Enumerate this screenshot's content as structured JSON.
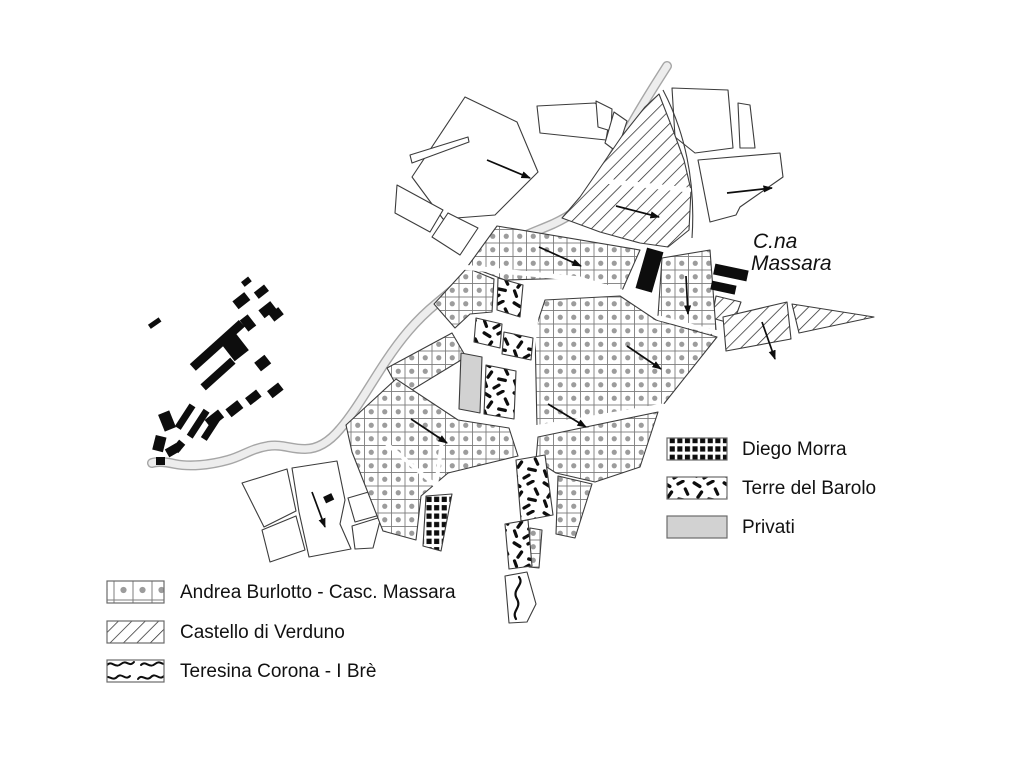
{
  "map_label": {
    "line1": "C.na",
    "line2": "Massara"
  },
  "legend_right": {
    "items": [
      {
        "label": "Diego Morra",
        "pattern": "black-checker"
      },
      {
        "label": "Terre del Barolo",
        "pattern": "black-dashes"
      },
      {
        "label": "Privati",
        "pattern": "solid-gray"
      }
    ]
  },
  "legend_left": {
    "items": [
      {
        "label": "Andrea Burlotto - Casc. Massara",
        "pattern": "dot-grid"
      },
      {
        "label": "Castello di Verduno",
        "pattern": "diagonal-hatch"
      },
      {
        "label": "Teresina Corona - I Brè",
        "pattern": "squiggle-lines"
      }
    ]
  },
  "colors": {
    "outline": "#3c3c3c",
    "dot": "#9c9c9c",
    "grid": "#7d7d7d",
    "ink": "#0d0d0d",
    "privati": "#d2d2d2",
    "roadfill": "#ededed",
    "roadedge": "#a6a6a6",
    "text": "#111111"
  }
}
